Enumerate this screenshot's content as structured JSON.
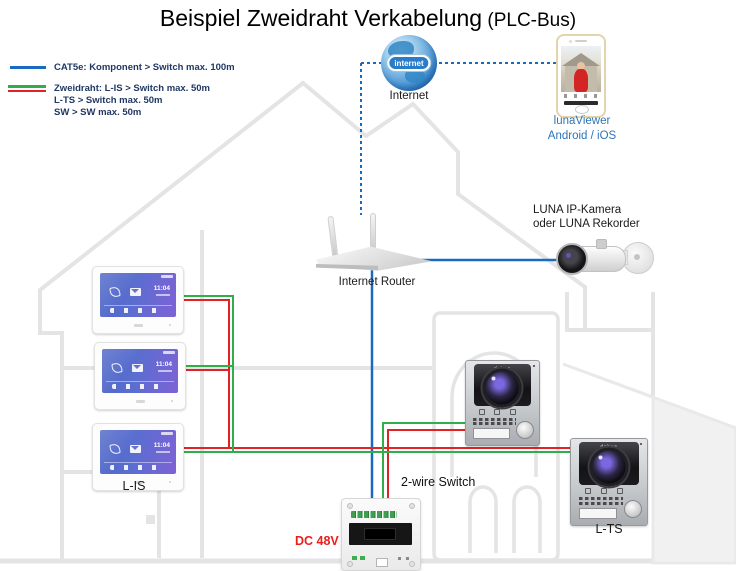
{
  "title": {
    "main": "Beispiel Zweidraht Verkabelung",
    "suffix": " (PLC-Bus)"
  },
  "legend": {
    "cat5e": "CAT5e: Komponent > Switch max. 100m",
    "zweidraht_line1": "Zweidraht: L-IS > Switch max. 50m",
    "zweidraht_line2": "L-TS > Switch max. 50m",
    "zweidraht_line3": "SW > SW max. 50m"
  },
  "nodes": {
    "internet": {
      "label": "Internet",
      "globe_text": "internet"
    },
    "app": {
      "label_line1": "lunaViewer",
      "label_line2": "Android / iOS"
    },
    "camera": {
      "label_line1": "LUNA IP-Kamera",
      "label_line2": "oder LUNA Rekorder"
    },
    "router": {
      "label": "Internet Router"
    },
    "indoor_monitor": {
      "label": "L-IS",
      "screen_time": "11:04"
    },
    "door_station": {
      "brand": "dahua"
    },
    "door_station_lts": {
      "label": "L-TS"
    },
    "switch": {
      "label": "2-wire Switch",
      "power_label": "DC 48V"
    }
  },
  "colors": {
    "cat5e_blue": "#1a6bbf",
    "wire_green": "#2fae4b",
    "wire_red": "#e02424",
    "legend_text": "#1f3864",
    "app_label_blue": "#2e75b6",
    "power_label_red": "#e8201c",
    "house_outline": "#e4e4e4"
  }
}
